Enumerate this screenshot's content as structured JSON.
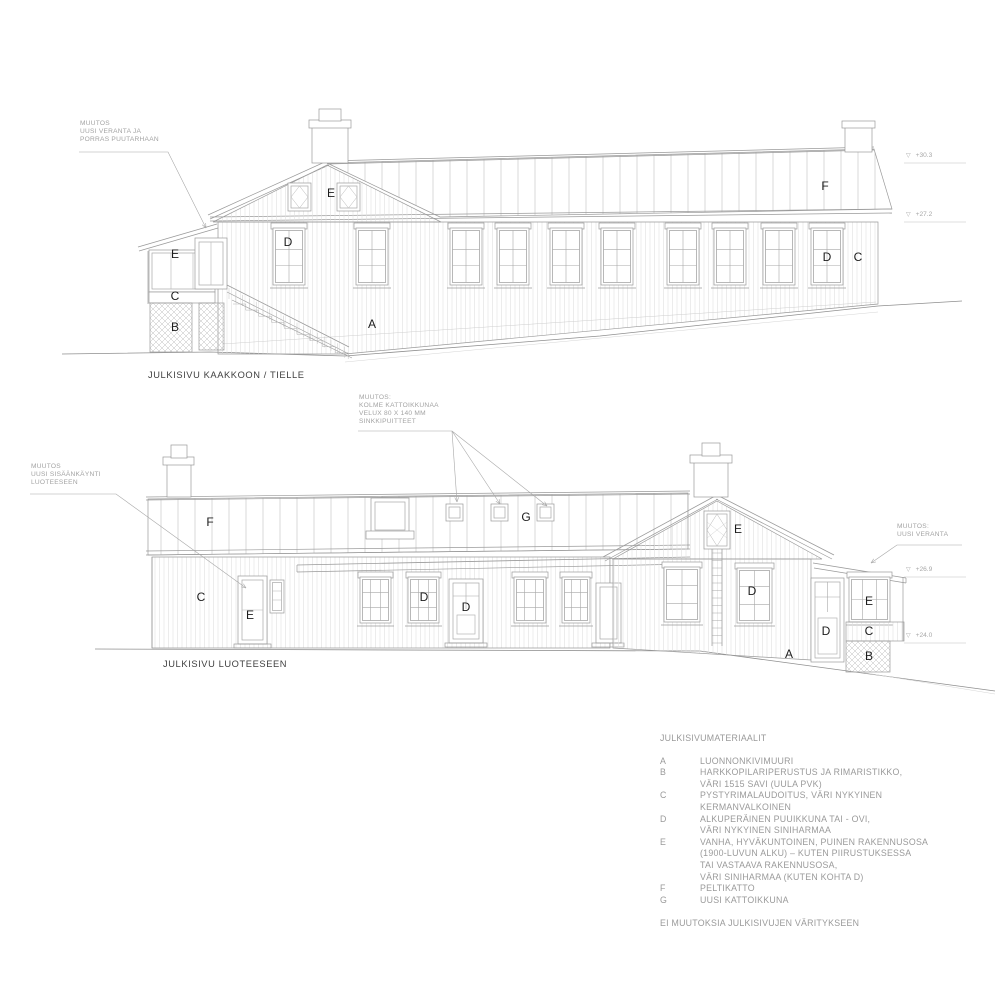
{
  "captions": {
    "southeast": "JULKISIVU KAAKKOON / TIELLE",
    "northwest": "JULKISIVU LUOTEESEEN"
  },
  "annotations": {
    "veranda_garden": [
      "MUUTOS",
      "UUSI VERANTA JA",
      "PORRAS PUUTARHAAN"
    ],
    "roof_windows": [
      "MUUTOS:",
      "KOLME KATTOIKKUNAA",
      "VELUX 80 X 140 MM",
      "SINKKIPUITTEET"
    ],
    "new_entrance": [
      "MUUTOS",
      "UUSI SISÄÄNKÄYNTI",
      "LUOTEESEEN"
    ],
    "new_veranda": [
      "MUUTOS:",
      "UUSI VERANTA"
    ]
  },
  "level_marks": {
    "icon": "▽",
    "ridge": "+30.3",
    "eaves": "+27.2",
    "veranda_roof": "+26.9",
    "veranda_base": "+24.0"
  },
  "material_labels": {
    "top": [
      "E",
      "D",
      "E",
      "C",
      "B",
      "A",
      "F",
      "D",
      "C"
    ],
    "bottom": [
      "F",
      "C",
      "E",
      "G",
      "D",
      "D",
      "D",
      "E",
      "D",
      "E",
      "C",
      "B",
      "A"
    ]
  },
  "legend": {
    "title": "JULKISIVUMATERIAALIT",
    "items": [
      {
        "key": "A",
        "lines": [
          "LUONNONKIVIMUURI"
        ]
      },
      {
        "key": "B",
        "lines": [
          "HARKKOPILARIPERUSTUS JA RIMARISTIKKO,",
          "VÄRI 1515 SAVI (UULA PVK)"
        ]
      },
      {
        "key": "C",
        "lines": [
          "PYSTYRIMALAUDOITUS, VÄRI NYKYINEN",
          "KERMANVALKOINEN"
        ]
      },
      {
        "key": "D",
        "lines": [
          "ALKUPERÄINEN PUUIKKUNA TAI - OVI,",
          "VÄRI NYKYINEN SINIHARMAA"
        ]
      },
      {
        "key": "E",
        "lines": [
          "VANHA, HYVÄKUNTOINEN, PUINEN RAKENNUSOSA",
          "(1900-LUVUN ALKU) – KUTEN PIIRUSTUKSESSA",
          "TAI VASTAAVA RAKENNUSOSA,",
          "VÄRI SINIHARMAA (KUTEN KOHTA D)"
        ]
      },
      {
        "key": "F",
        "lines": [
          "PELTIKATTO"
        ]
      },
      {
        "key": "G",
        "lines": [
          "UUSI KATTOIKKUNA"
        ]
      }
    ],
    "footer": "EI MUUTOKSIA JULKISIVUJEN VÄRITYKSEEN"
  }
}
